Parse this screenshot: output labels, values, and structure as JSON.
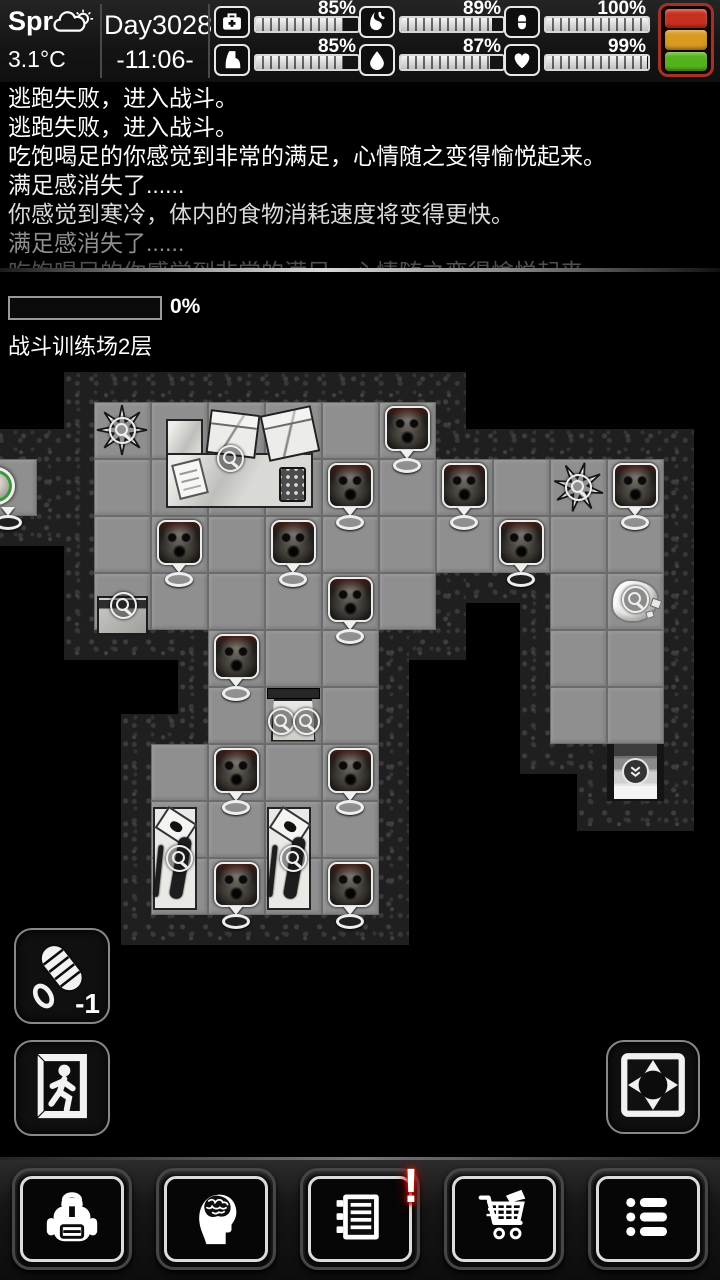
{
  "header": {
    "season": "Spr",
    "temperature": "3.1°C",
    "day": "Day3028",
    "time": "-11:06-",
    "stats": [
      {
        "name": "health",
        "icon": "medkit-icon",
        "percent": 85,
        "label": "85%"
      },
      {
        "name": "stamina",
        "icon": "boot-icon",
        "percent": 85,
        "label": "85%"
      },
      {
        "name": "satiety",
        "icon": "stomach-icon",
        "percent": 89,
        "label": "89%"
      },
      {
        "name": "hydration",
        "icon": "drop-icon",
        "percent": 87,
        "label": "87%"
      },
      {
        "name": "medicine",
        "icon": "pill-icon",
        "percent": 100,
        "label": "100%"
      },
      {
        "name": "mood",
        "icon": "heart-icon",
        "percent": 99,
        "label": "99%"
      }
    ],
    "status_light": {
      "colors": [
        "#c6301f",
        "#d99a20",
        "#55b21d"
      ]
    }
  },
  "log": {
    "lines": [
      {
        "text": "逃跑失败，进入战斗。",
        "color": "#ffffff"
      },
      {
        "text": "逃跑失败，进入战斗。",
        "color": "#ffffff"
      },
      {
        "text": "吃饱喝足的你感觉到非常的满足，心情随之变得愉悦起来。",
        "color": "#ffffff"
      },
      {
        "text": "满足感消失了......",
        "color": "#f2f2f2"
      },
      {
        "text": "你感觉到寒冷，体内的食物消耗速度将变得更快。",
        "color": "#d9d9d9"
      },
      {
        "text": "满足感消失了......",
        "color": "#8f8f8f"
      },
      {
        "text": "吃饱喝足的你感觉到非常的满足，心情随之变得愉悦起来",
        "color": "#4f4f4f"
      }
    ]
  },
  "progress": {
    "label": "0%",
    "value": 0
  },
  "map": {
    "title": "战斗训练场2层",
    "tile_size": 57,
    "origin": {
      "x": -20.5,
      "y": 401.5
    },
    "floor_tiles": [
      [
        2,
        0
      ],
      [
        3,
        0
      ],
      [
        4,
        0
      ],
      [
        5,
        0
      ],
      [
        6,
        0
      ],
      [
        7,
        0
      ],
      [
        0,
        1
      ],
      [
        2,
        1
      ],
      [
        3,
        1
      ],
      [
        4,
        1
      ],
      [
        5,
        1
      ],
      [
        6,
        1
      ],
      [
        7,
        1
      ],
      [
        8,
        1
      ],
      [
        9,
        1
      ],
      [
        10,
        1
      ],
      [
        11,
        1
      ],
      [
        2,
        2
      ],
      [
        3,
        2
      ],
      [
        4,
        2
      ],
      [
        5,
        2
      ],
      [
        6,
        2
      ],
      [
        7,
        2
      ],
      [
        8,
        2
      ],
      [
        9,
        2
      ],
      [
        10,
        2
      ],
      [
        11,
        2
      ],
      [
        2,
        3
      ],
      [
        3,
        3
      ],
      [
        4,
        3
      ],
      [
        5,
        3
      ],
      [
        6,
        3
      ],
      [
        7,
        3
      ],
      [
        10,
        3
      ],
      [
        11,
        3
      ],
      [
        4,
        4
      ],
      [
        5,
        4
      ],
      [
        6,
        4
      ],
      [
        10,
        4
      ],
      [
        11,
        4
      ],
      [
        4,
        5
      ],
      [
        5,
        5
      ],
      [
        6,
        5
      ],
      [
        10,
        5
      ],
      [
        11,
        5
      ],
      [
        3,
        6
      ],
      [
        4,
        6
      ],
      [
        5,
        6
      ],
      [
        6,
        6
      ],
      [
        3,
        7
      ],
      [
        4,
        7
      ],
      [
        5,
        7
      ],
      [
        6,
        7
      ],
      [
        3,
        8
      ],
      [
        4,
        8
      ],
      [
        5,
        8
      ],
      [
        6,
        8
      ]
    ],
    "stairs_tile": [
      11,
      6
    ],
    "player_tile": [
      0,
      1
    ],
    "zombie_tiles": [
      [
        7,
        0
      ],
      [
        6,
        1
      ],
      [
        8,
        1
      ],
      [
        11,
        1
      ],
      [
        3,
        2
      ],
      [
        5,
        2
      ],
      [
        9,
        2
      ],
      [
        6,
        3
      ],
      [
        4,
        4
      ],
      [
        4,
        6
      ],
      [
        6,
        6
      ],
      [
        4,
        8
      ],
      [
        6,
        8
      ]
    ],
    "plant_tiles": [
      [
        2,
        0
      ],
      [
        10,
        1
      ]
    ],
    "crate_tile": [
      2,
      3
    ],
    "cloth_pile_tile": [
      11,
      3
    ],
    "small_table_tile": [
      5,
      5
    ],
    "gun_desk_tiles": [
      [
        3,
        7
      ],
      [
        5,
        7
      ]
    ],
    "office_desk_tile": [
      3,
      0
    ]
  },
  "actions": {
    "rope_count": "-1"
  },
  "nav": {
    "items": [
      {
        "name": "inventory",
        "icon": "backpack-icon"
      },
      {
        "name": "character",
        "icon": "head-brain-icon"
      },
      {
        "name": "journal",
        "icon": "journal-icon",
        "badge": "!"
      },
      {
        "name": "shop",
        "icon": "cart-icon"
      },
      {
        "name": "menu",
        "icon": "list-icon"
      }
    ]
  }
}
